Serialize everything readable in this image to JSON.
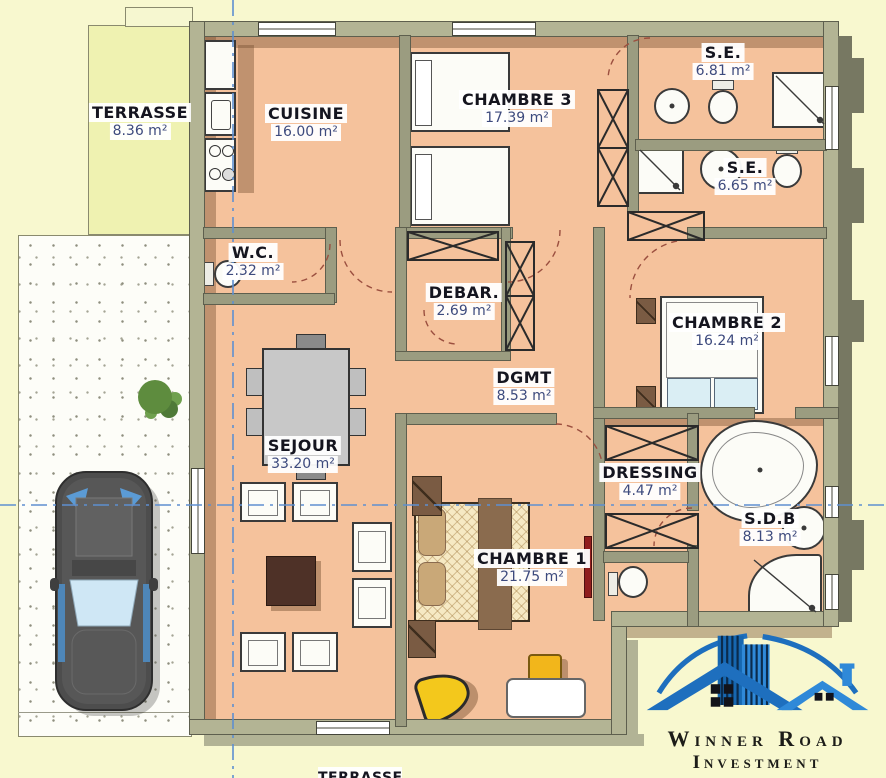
{
  "rooms": [
    {
      "name": "TERRASSE",
      "area": "8.36 m²"
    },
    {
      "name": "CUISINE",
      "area": "16.00 m²"
    },
    {
      "name": "CHAMBRE 3",
      "area": "17.39 m²"
    },
    {
      "name": "S.E.",
      "area": "6.81 m²"
    },
    {
      "name": "S.E.",
      "area": "6.65 m²"
    },
    {
      "name": "W.C.",
      "area": "2.32 m²"
    },
    {
      "name": "DEBAR.",
      "area": "2.69 m²"
    },
    {
      "name": "DGMT",
      "area": "8.53 m²"
    },
    {
      "name": "CHAMBRE 2",
      "area": "16.24 m²"
    },
    {
      "name": "SEJOUR",
      "area": "33.20 m²"
    },
    {
      "name": "DRESSING",
      "area": "4.47 m²"
    },
    {
      "name": "CHAMBRE 1",
      "area": "21.75 m²"
    },
    {
      "name": "S.D.B",
      "area": "8.13 m²"
    }
  ],
  "bottom_partial_label": "TERRASSE",
  "logo": {
    "line1": "Winner Road",
    "line2": "Investment"
  },
  "colors": {
    "floor": "#F5C29C",
    "terrace": "#EFF2B1",
    "outdoor": "#F8F8CF",
    "wall": "#9B9C80",
    "axis_blue": "#5E8FD0",
    "logo_blue": "#1E6FBE"
  }
}
